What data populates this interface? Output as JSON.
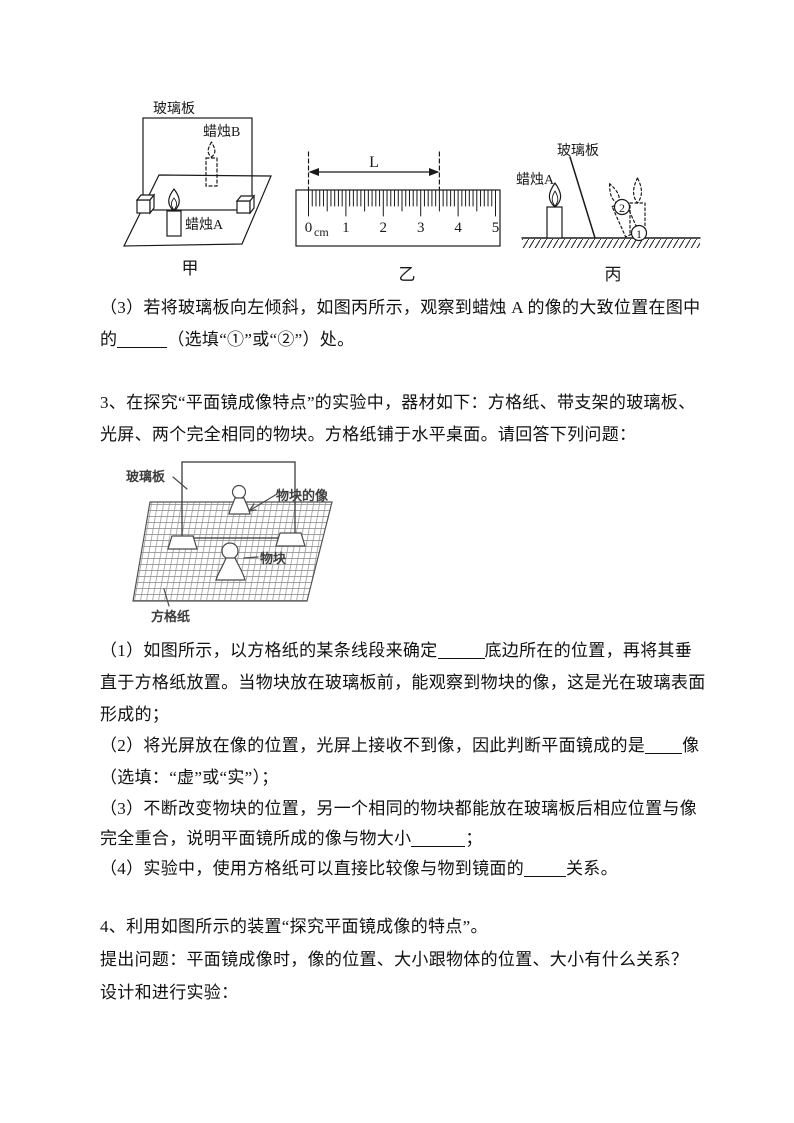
{
  "figures": {
    "jia": {
      "glass_label": "玻璃板",
      "candle_b_label": "蜡烛B",
      "candle_a_label": "蜡烛A",
      "caption": "甲"
    },
    "yi": {
      "length_label": "L",
      "zero": "0",
      "unit": "cm",
      "ticks": [
        "1",
        "2",
        "3",
        "4",
        "5"
      ],
      "caption": "乙"
    },
    "bing": {
      "glass_label": "玻璃板",
      "candle_a_label": "蜡烛A",
      "pos2_digit": "2",
      "pos1_digit": "1",
      "caption": "丙"
    },
    "grid": {
      "glass_label": "玻璃板",
      "image_label": "物块的像",
      "block_label": "物块",
      "paper_label": "方格纸"
    }
  },
  "q2_part3": {
    "line1": "（3）若将玻璃板向左倾斜，如图丙所示，观察到蜡烛 A 的像的大致位置在图中",
    "line2_pre": "的",
    "line2_post": "（选填“①”或“②”）处。"
  },
  "q3": {
    "intro_line1": "3、在探究“平面镜成像特点”的实验中，器材如下：方格纸、带支架的玻璃板、",
    "intro_line2": "光屏、两个完全相同的物块。方格纸铺于水平桌面。请回答下列问题：",
    "part1_pre": "（1）如图所示，以方格纸的某条线段来确定",
    "part1_post": "底边所在的位置，再将其垂",
    "part1_line2": "直于方格纸放置。当物块放在玻璃板前，能观察到物块的像，这是光在玻璃表面",
    "part1_line3": "形成的；",
    "part2_pre": "（2）将光屏放在像的位置，光屏上接收不到像，因此判断平面镜成的是",
    "part2_post": "像",
    "part2_line2": "（选填：“虚”或“实”）；",
    "part3_line1": "（3）不断改变物块的位置，另一个相同的物块都能放在玻璃板后相应位置与像",
    "part3_pre": "完全重合，说明平面镜所成的像与物大小",
    "part3_post": "；",
    "part4_pre": "（4）实验中，使用方格纸可以直接比较像与物到镜面的",
    "part4_post": "关系。"
  },
  "q4": {
    "line1": "4、利用如图所示的装置“探究平面镜成像的特点”。",
    "line2": "提出问题：平面镜成像时，像的位置、大小跟物体的位置、大小有什么关系？",
    "line3": "设计和进行实验："
  }
}
